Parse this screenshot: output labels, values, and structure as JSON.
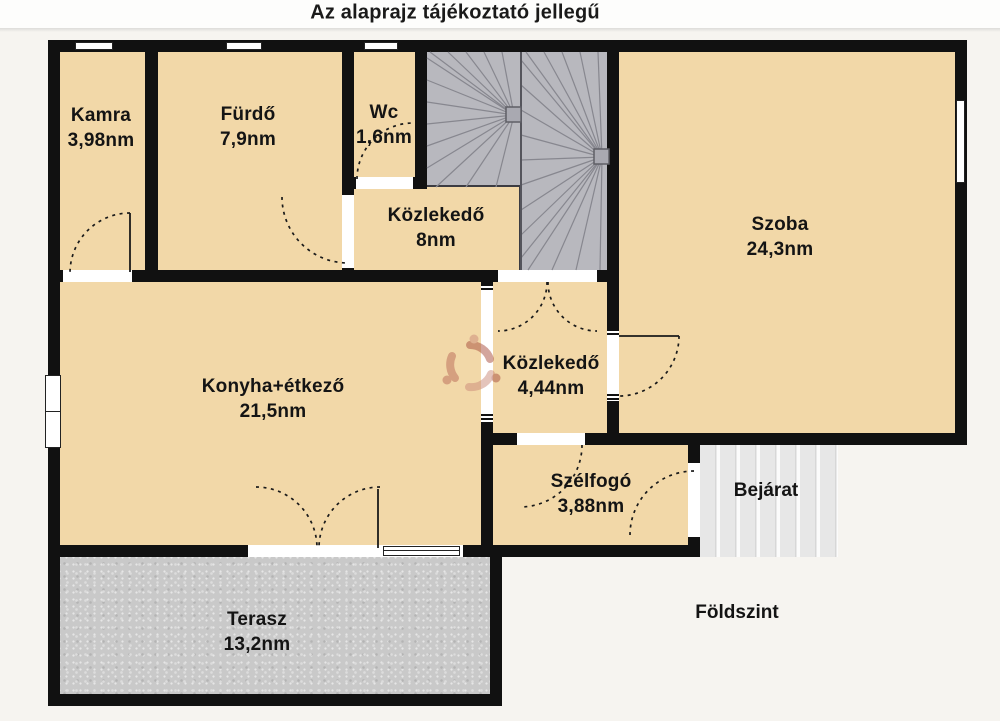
{
  "title": "Az alaprajz tájékoztató jellegű",
  "floor_level_label": "Földszint",
  "entrance_label": "Bejárat",
  "rooms": [
    {
      "id": "kamra",
      "name": "Kamra",
      "area": "3,98nm"
    },
    {
      "id": "furdo",
      "name": "Fürdő",
      "area": "7,9nm"
    },
    {
      "id": "wc",
      "name": "Wc",
      "area": "1,6nm"
    },
    {
      "id": "kozlekedo-8",
      "name": "Közlekedő",
      "area": "8nm"
    },
    {
      "id": "szoba",
      "name": "Szoba",
      "area": "24,3nm"
    },
    {
      "id": "konyha",
      "name": "Konyha+étkező",
      "area": "21,5nm"
    },
    {
      "id": "kozlekedo-4",
      "name": "Közlekedő",
      "area": "4,44nm"
    },
    {
      "id": "szelfogo",
      "name": "Szélfogó",
      "area": "3,88nm"
    },
    {
      "id": "terasz",
      "name": "Terasz",
      "area": "13,2nm"
    }
  ],
  "colors": {
    "floor_fill": "#f2d8a8",
    "wall": "#111111",
    "stairs_fill": "#b8b8be",
    "stairs_line": "#87878f",
    "terrace_fill": "#c9c9c9",
    "entrance_steps": "#e7e7e7",
    "background": "#f6f4f0",
    "watermark_red": "#a84e3e",
    "watermark_light": "#cb8a7a"
  },
  "watermark": {
    "name": "ingatlan-portal-logo"
  }
}
